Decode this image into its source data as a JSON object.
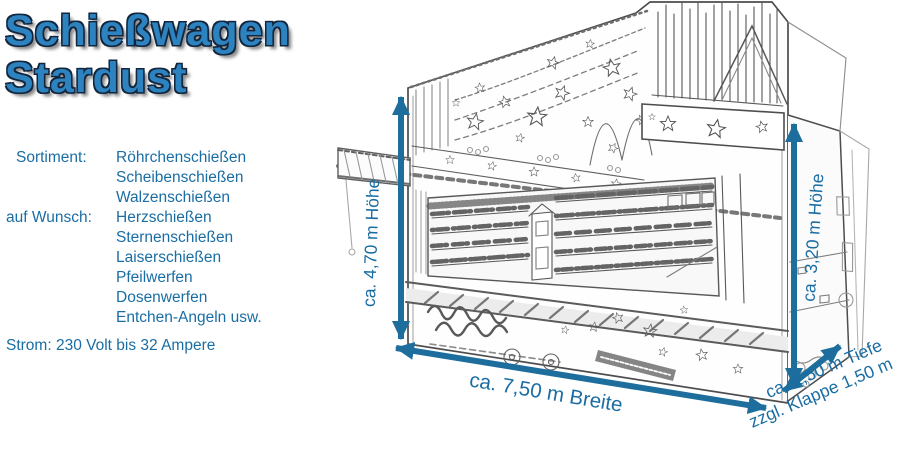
{
  "title": {
    "line1": "Schießwagen",
    "line2": "Stardust"
  },
  "specs": {
    "sortiment_label": "Sortiment:",
    "sortiment_items": [
      "Röhrchenschießen",
      "Scheibenschießen",
      "Walzenschießen"
    ],
    "wunsch_label": "auf Wunsch:",
    "wunsch_items": [
      "Herzschießen",
      "Sternenschießen",
      "Laiserschießen",
      "Pfeilwerfen",
      "Dosenwerfen",
      "Entchen-Angeln usw."
    ],
    "power": "Strom: 230 Volt bis 32 Ampere"
  },
  "dimensions": {
    "height_left": "ca. 4,70 m Höhe",
    "height_right": "ca. 3,20 m Höhe",
    "width": "ca. 7,50 m Breite",
    "depth": "ca. 2,50 m Tiefe",
    "depth_extra": "zzgl. Klappe 1,50 m"
  },
  "colors": {
    "title_blue": "#2d83bf",
    "title_outline": "#12263e",
    "text_blue": "#1a6da3",
    "arrow_blue": "#1d6e9d",
    "sketch_ink": "#333333"
  }
}
